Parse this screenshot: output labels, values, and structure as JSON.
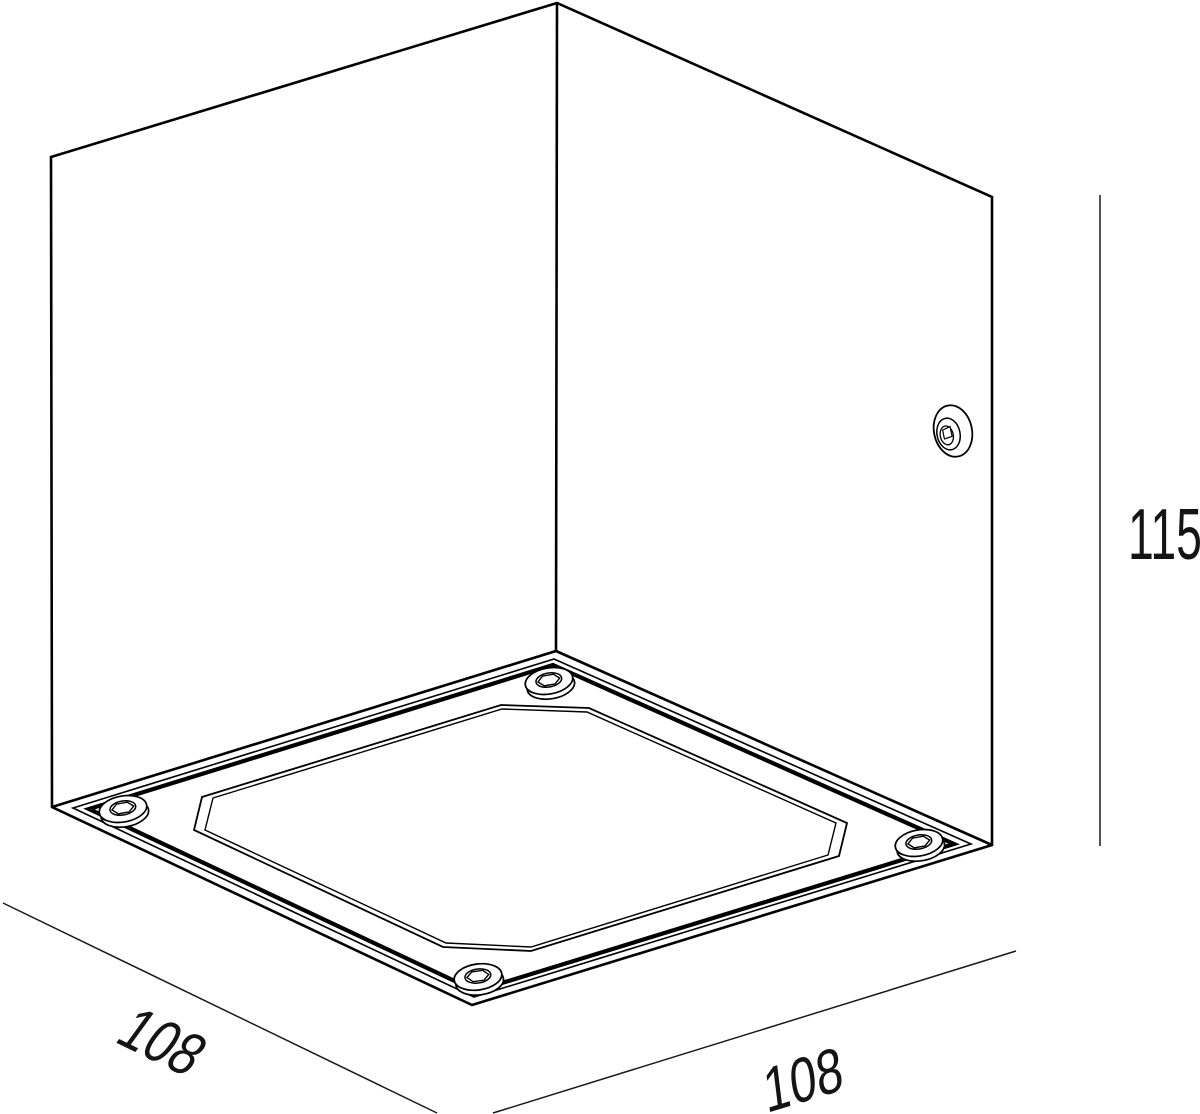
{
  "drawing": {
    "background_color": "#ffffff",
    "line_color": "#000000",
    "dimensions": {
      "height": "115",
      "width_left": "108",
      "width_right": "108"
    }
  }
}
